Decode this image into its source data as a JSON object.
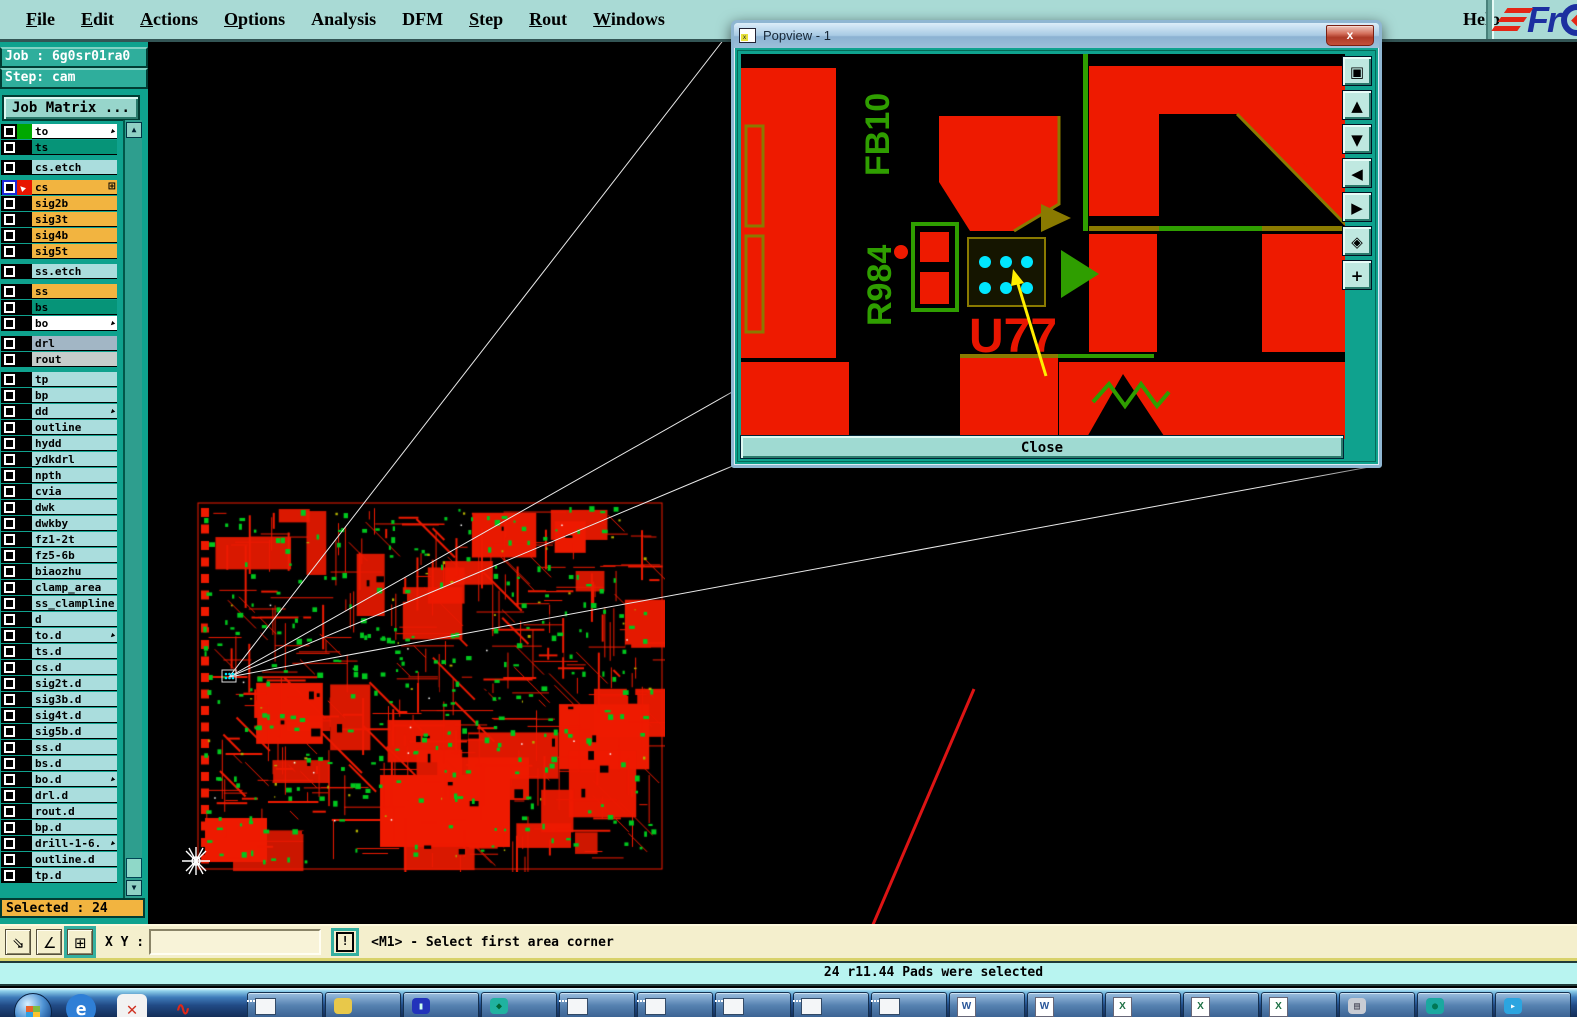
{
  "menu": {
    "items": [
      {
        "label": "File",
        "u": 0
      },
      {
        "label": "Edit",
        "u": 0
      },
      {
        "label": "Actions",
        "u": 0
      },
      {
        "label": "Options",
        "u": 0
      },
      {
        "label": "Analysis",
        "u": -1
      },
      {
        "label": "DFM",
        "u": -1
      },
      {
        "label": "Step",
        "u": 0
      },
      {
        "label": "Rout",
        "u": 0
      },
      {
        "label": "Windows",
        "u": 0
      }
    ],
    "help_label": "Help",
    "logo_text": "Fr"
  },
  "sidebar": {
    "job_label": "Job : 6g0sr01ra0",
    "step_label": "Step: cam",
    "job_matrix_label": "Job Matrix ...",
    "selected_label": "Selected : 24",
    "groups": [
      [
        {
          "name": "to",
          "bg": "#ffffff",
          "swatch": "#00a800",
          "arrow": true
        },
        {
          "name": "ts",
          "bg": "#069478"
        }
      ],
      [
        {
          "name": "cs.etch",
          "bg": "#aadddd"
        }
      ],
      [
        {
          "name": "cs",
          "bg": "#f2b440",
          "swatch": "#e81500",
          "swatch_arrow": true,
          "active": true,
          "grid": true
        },
        {
          "name": "sig2b",
          "bg": "#f2b440"
        },
        {
          "name": "sig3t",
          "bg": "#f2b440"
        },
        {
          "name": "sig4b",
          "bg": "#f2b440"
        },
        {
          "name": "sig5t",
          "bg": "#f2b440"
        }
      ],
      [
        {
          "name": "ss.etch",
          "bg": "#aadddd"
        }
      ],
      [
        {
          "name": "ss",
          "bg": "#f2b440"
        },
        {
          "name": "bs",
          "bg": "#069478"
        },
        {
          "name": "bo",
          "bg": "#ffffff",
          "arrow": true
        }
      ],
      [
        {
          "name": "drl",
          "bg": "#a2b6c5"
        },
        {
          "name": "rout",
          "bg": "#c6cdcb"
        }
      ],
      [
        {
          "name": "tp",
          "bg": "#aadddd"
        },
        {
          "name": "bp",
          "bg": "#aadddd"
        },
        {
          "name": "dd",
          "bg": "#aadddd",
          "arrow": true
        },
        {
          "name": "outline",
          "bg": "#aadddd"
        },
        {
          "name": "hydd",
          "bg": "#aadddd"
        },
        {
          "name": "ydkdrl",
          "bg": "#aadddd"
        },
        {
          "name": "npth",
          "bg": "#aadddd"
        },
        {
          "name": "cvia",
          "bg": "#aadddd"
        },
        {
          "name": "dwk",
          "bg": "#aadddd"
        },
        {
          "name": "dwkby",
          "bg": "#aadddd"
        },
        {
          "name": "fz1-2t",
          "bg": "#aadddd"
        },
        {
          "name": "fz5-6b",
          "bg": "#aadddd"
        },
        {
          "name": "biaozhu",
          "bg": "#aadddd"
        },
        {
          "name": "clamp_area",
          "bg": "#aadddd"
        },
        {
          "name": "ss_clampline",
          "bg": "#aadddd"
        },
        {
          "name": "d",
          "bg": "#aadddd"
        },
        {
          "name": "to.d",
          "bg": "#aadddd",
          "arrow": true
        },
        {
          "name": "ts.d",
          "bg": "#aadddd"
        },
        {
          "name": "cs.d",
          "bg": "#aadddd"
        },
        {
          "name": "sig2t.d",
          "bg": "#aadddd"
        },
        {
          "name": "sig3b.d",
          "bg": "#aadddd"
        },
        {
          "name": "sig4t.d",
          "bg": "#aadddd"
        },
        {
          "name": "sig5b.d",
          "bg": "#aadddd"
        },
        {
          "name": "ss.d",
          "bg": "#aadddd"
        },
        {
          "name": "bs.d",
          "bg": "#aadddd"
        },
        {
          "name": "bo.d",
          "bg": "#aadddd",
          "arrow": true
        },
        {
          "name": "drl.d",
          "bg": "#aadddd"
        },
        {
          "name": "rout.d",
          "bg": "#aadddd"
        },
        {
          "name": "bp.d",
          "bg": "#aadddd"
        },
        {
          "name": "drill-1-6.",
          "bg": "#aadddd",
          "arrow": true
        },
        {
          "name": "outline.d",
          "bg": "#aadddd"
        },
        {
          "name": "tp.d",
          "bg": "#aadddd"
        }
      ]
    ]
  },
  "commandbar": {
    "tools": [
      {
        "name": "measure-distance-tool",
        "glyph": "⇘",
        "active": false
      },
      {
        "name": "measure-angle-tool",
        "glyph": "∠",
        "active": false
      },
      {
        "name": "grid-snap-tool",
        "glyph": "⊞",
        "active": true
      }
    ],
    "xy_label": "X Y :",
    "input_value": "",
    "alert_glyph": "!",
    "prompt": "<M1> - Select first area corner"
  },
  "statusbar": {
    "text": "24 r11.44 Pads were selected"
  },
  "popview": {
    "title": "Popview - 1",
    "close_glyph": "x",
    "close_button_label": "Close",
    "labels": {
      "fb10": "FB10",
      "r984": "R984",
      "u77": "U77"
    },
    "toolbar": [
      {
        "name": "popup-window-icon",
        "glyph": "▣"
      },
      {
        "name": "pan-up-icon",
        "glyph": "▲"
      },
      {
        "name": "pan-down-icon",
        "glyph": "▼"
      },
      {
        "name": "pan-left-icon",
        "glyph": "◀"
      },
      {
        "name": "pan-right-icon",
        "glyph": "▶"
      },
      {
        "name": "zoom-center-icon",
        "glyph": "◈"
      },
      {
        "name": "zoom-fit-icon",
        "glyph": "+"
      }
    ]
  },
  "taskbar": {
    "quick_icons": [
      {
        "name": "start-orb",
        "kind": "orb"
      },
      {
        "name": "ie-icon",
        "kind": "blob",
        "glyph": "e",
        "bg": "#2f7fd6",
        "fg": "#ffffff"
      },
      {
        "name": "app-x-icon",
        "kind": "blob",
        "glyph": "✕",
        "bg": "#f2f2f2",
        "fg": "#d03020"
      },
      {
        "name": "red-swoosh-icon",
        "kind": "blob",
        "glyph": "∿",
        "bg": "#00000000",
        "fg": "#e02818"
      }
    ],
    "apps": [
      {
        "name": "taskbar-app-window-1",
        "kind": "window"
      },
      {
        "name": "taskbar-app-shell",
        "kind": "blob",
        "glyph": "",
        "bg": "#e8c84a",
        "fg": "#664"
      },
      {
        "name": "taskbar-app-floppy",
        "kind": "blob",
        "glyph": "▮",
        "bg": "#2233bb",
        "fg": "#cfe"
      },
      {
        "name": "taskbar-app-teal-fish",
        "kind": "blob",
        "glyph": "◆",
        "bg": "#20b2a0",
        "fg": "#063"
      },
      {
        "name": "taskbar-app-window-2",
        "kind": "window"
      },
      {
        "name": "taskbar-app-window-3",
        "kind": "window"
      },
      {
        "name": "taskbar-app-window-4",
        "kind": "window"
      },
      {
        "name": "taskbar-app-window-5",
        "kind": "window"
      },
      {
        "name": "taskbar-app-window-6",
        "kind": "window"
      },
      {
        "name": "taskbar-app-word-1",
        "kind": "doc",
        "glyph": "W",
        "fg": "#2a5699"
      },
      {
        "name": "taskbar-app-word-2",
        "kind": "doc",
        "glyph": "W",
        "fg": "#2a5699"
      },
      {
        "name": "taskbar-app-excel-1",
        "kind": "doc",
        "glyph": "X",
        "fg": "#1e7145"
      },
      {
        "name": "taskbar-app-excel-2",
        "kind": "doc",
        "glyph": "X",
        "fg": "#1e7145"
      },
      {
        "name": "taskbar-app-excel-3",
        "kind": "doc",
        "glyph": "X",
        "fg": "#1e7145"
      },
      {
        "name": "taskbar-app-keyboard",
        "kind": "blob",
        "glyph": "▤",
        "bg": "#c8ccd4",
        "fg": "#445"
      },
      {
        "name": "taskbar-app-teal",
        "kind": "blob",
        "glyph": "●",
        "bg": "#1aa8a0",
        "fg": "#075"
      },
      {
        "name": "taskbar-app-telegram",
        "kind": "blob",
        "glyph": "▸",
        "bg": "#2ca5e0",
        "fg": "#ffffff"
      }
    ]
  },
  "icons": {
    "layer_arrow_glyph": "▶",
    "cs_pointer_glyph": "▶",
    "cs_grid_glyph": "⊞",
    "scroll_up_glyph": "▲",
    "scroll_down_glyph": "▼"
  },
  "colors": {
    "pcb_red": "#ee1a00",
    "pcb_green": "#00c81e",
    "silk_green": "#2f9e00",
    "pad_cyan": "#00e6ff",
    "mustard": "#8a7a00",
    "arrow_yellow": "#ffee00",
    "arrow_red": "#dd1414",
    "select_orange": "#f2b440"
  }
}
